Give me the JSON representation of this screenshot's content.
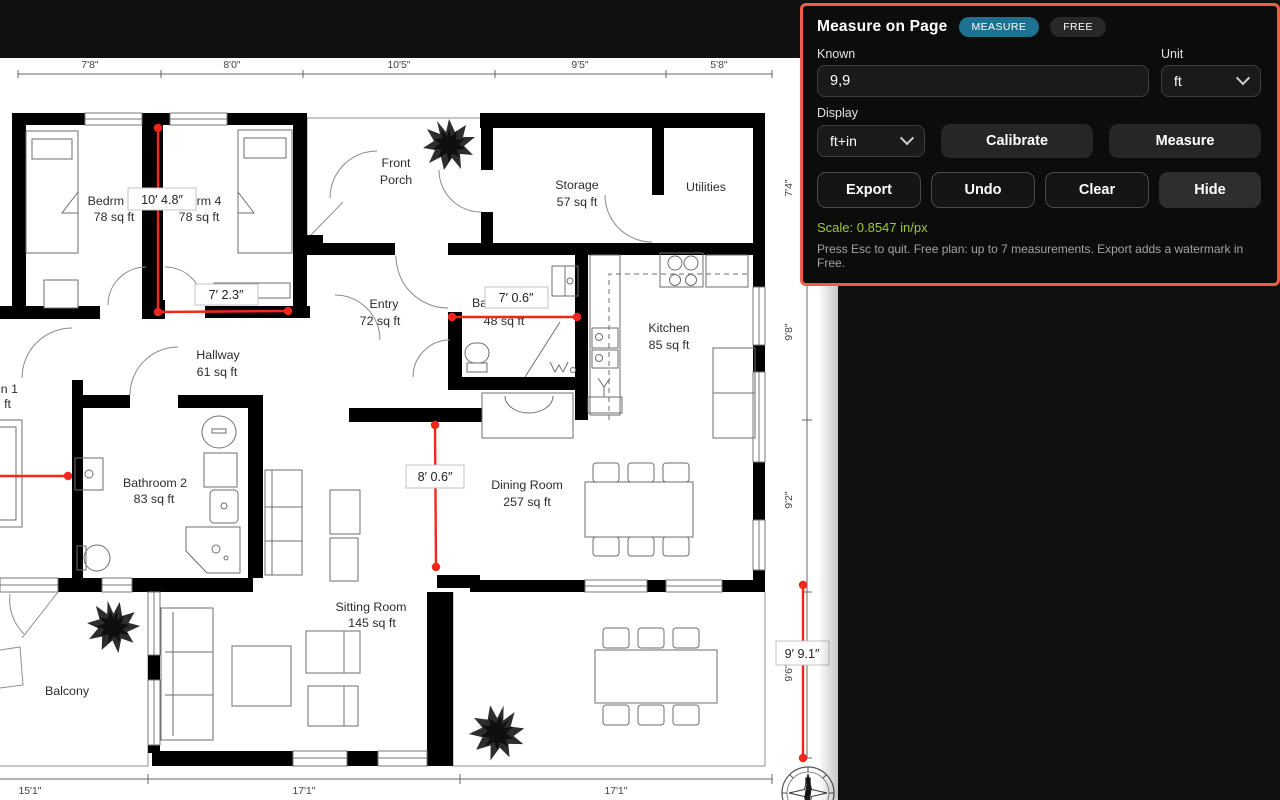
{
  "panel": {
    "title": "Measure on Page",
    "badges": {
      "mode": "MEASURE",
      "plan": "FREE"
    },
    "known": {
      "label": "Known",
      "value": "9,9"
    },
    "unit": {
      "label": "Unit",
      "value": "ft"
    },
    "display": {
      "label": "Display",
      "value": "ft+in"
    },
    "buttons": {
      "calibrate": "Calibrate",
      "measure": "Measure",
      "export": "Export",
      "undo": "Undo",
      "clear": "Clear",
      "hide": "Hide"
    },
    "scale_text": "Scale: 0.8547 in/px",
    "help_text": "Press Esc to quit. Free plan: up to 7 measurements. Export adds a watermark in Free.",
    "colors": {
      "accent_border": "#f15b4a",
      "badge_teal": "#1e7191",
      "scale_green": "#9ecb34"
    }
  },
  "plan": {
    "colors": {
      "measure_red": "#f2271c"
    },
    "top_dims": [
      "7'8\"",
      "8'0\"",
      "10'5\"",
      "9'5\"",
      "5'8\""
    ],
    "bottom_dims": [
      "15'1\"",
      "17'1\"",
      "17'1\""
    ],
    "right_dims": [
      "7'4\"",
      "9'8\"",
      "9'2\"",
      "9'6\""
    ],
    "rooms": [
      {
        "l1": "Bedrm 3",
        "l2": "78 sq ft"
      },
      {
        "l1": "Bedrm 4",
        "l2": "78 sq ft"
      },
      {
        "l1": "Front",
        "l2": "Porch"
      },
      {
        "l1": "Storage",
        "l2": "57 sq ft"
      },
      {
        "l1": "Utilities",
        "l2": ""
      },
      {
        "l1": "Entry",
        "l2": "72 sq ft"
      },
      {
        "l1": "Bathroom 1",
        "l2": "48 sq ft"
      },
      {
        "l1": "Kitchen",
        "l2": "85 sq ft"
      },
      {
        "l1": "Hallway",
        "l2": "61 sq ft"
      },
      {
        "l1": "Bathroom 2",
        "l2": "83 sq ft"
      },
      {
        "l1": "Dining Room",
        "l2": "257 sq ft"
      },
      {
        "l1": "Sitting Room",
        "l2": "145 sq ft"
      },
      {
        "l1": "Balcony",
        "l2": ""
      }
    ],
    "truncated_room": {
      "l1": "n 1",
      "l2": "ft"
    },
    "measurements": [
      {
        "label": "10′ 4.8″"
      },
      {
        "label": "7′ 2.3″"
      },
      {
        "label": "7′ 0.6″"
      },
      {
        "label": "8′ 0.6″"
      },
      {
        "label": "9′ 9.1″"
      }
    ],
    "compass_n": "N"
  }
}
